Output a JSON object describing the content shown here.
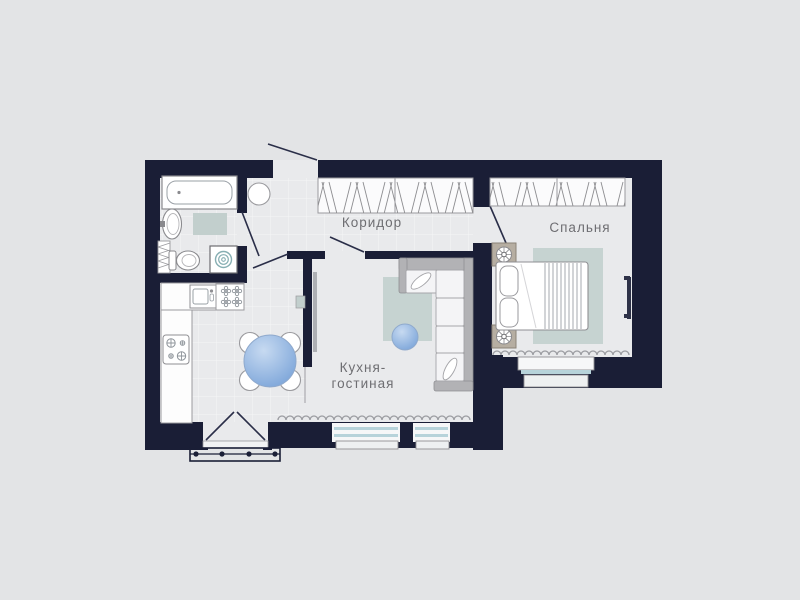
{
  "plan": {
    "type": "apartment-floor-plan",
    "labels": {
      "corridor": "Коридор",
      "bedroom": "Спальня",
      "kitchen_living_line1": "Кухня-",
      "kitchen_living_line2": "гостиная"
    },
    "colors": {
      "wall": "#1a1e36",
      "floor": "#e9eaec",
      "background": "#e3e4e6",
      "rug_teal": "#c6d3d1",
      "table_blue": "#7fa7da",
      "window_blue": "#b7d3da",
      "spiral_teal": "#86aeb2",
      "sofa_gray": "#b2b2b5",
      "nightstand_tan": "#b6aea2"
    },
    "fixtures": [
      "bathtub",
      "bath-mat",
      "washbasin",
      "toilet",
      "towel-rail",
      "washing-machine",
      "pouf",
      "wardrobe-corridor",
      "wardrobe-bedroom",
      "kitchen-counter",
      "kitchen-sink",
      "stove",
      "cooktop",
      "dining-table",
      "chair",
      "partition-tv-panel",
      "console-shelf",
      "corner-sofa",
      "sofa-pillow",
      "ottoman",
      "living-rug",
      "bedroom-rug",
      "double-bed",
      "pillow",
      "nightstand",
      "table-lamp",
      "wall-tv",
      "radiator",
      "window",
      "french-balcony-door",
      "balcony-railing",
      "entrance-door",
      "interior-door"
    ]
  }
}
